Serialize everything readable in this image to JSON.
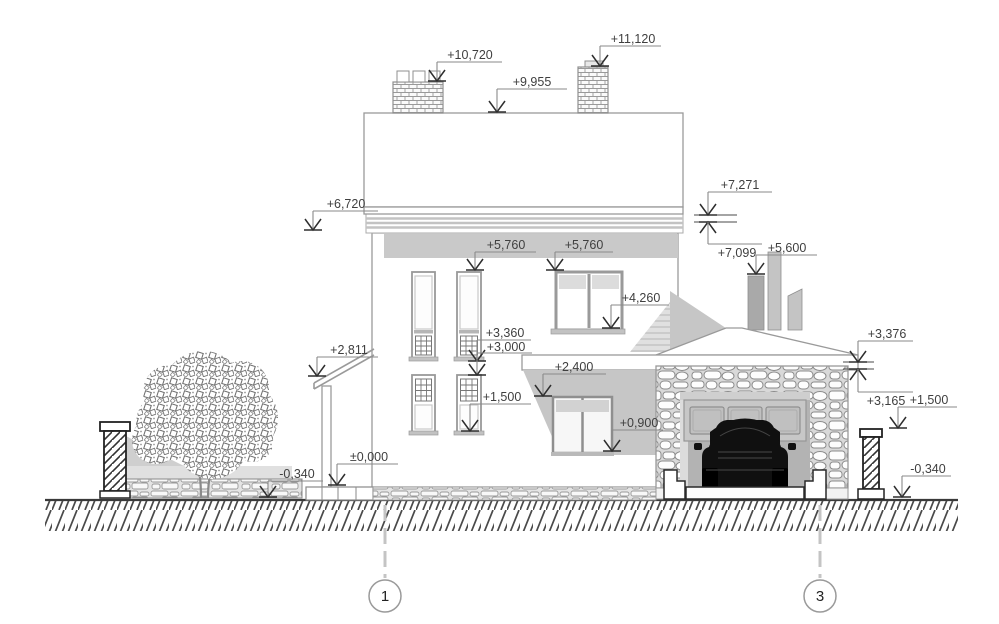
{
  "drawing": {
    "type": "architectural-elevation",
    "subject": "house side elevation between axes 1 and 3",
    "colors": {
      "outline": "#9a9a9a",
      "dark_outline": "#2a2a2a",
      "annotation_text": "#3f3f3f",
      "band_gray": "#c9c9c9",
      "recess_gray": "#c6c6c6",
      "garage_interior": "#b3b3b3",
      "car": "#101010",
      "background": "#ffffff"
    },
    "levels": [
      {
        "id": "chimney-left-top",
        "label": "+10,720"
      },
      {
        "id": "roof-top",
        "label": "+9,955"
      },
      {
        "id": "chimney-right-top",
        "label": "+11,120"
      },
      {
        "id": "roof-edge-top",
        "label": "+7,271"
      },
      {
        "id": "roof-edge-bottom",
        "label": "+7,099"
      },
      {
        "id": "flue-top",
        "label": "+5,600"
      },
      {
        "id": "main-eaves",
        "label": "+6,720"
      },
      {
        "id": "window-head-left",
        "label": "+5,760"
      },
      {
        "id": "window-head-right",
        "label": "+5,760"
      },
      {
        "id": "upper-right-window-sill",
        "label": "+4,260"
      },
      {
        "id": "upper-left-window-sill",
        "label": "+3,360"
      },
      {
        "id": "porch-roof-high",
        "label": "+3,000"
      },
      {
        "id": "porch-roof-low",
        "label": "+2,811"
      },
      {
        "id": "terrace-window-head",
        "label": "+2,400"
      },
      {
        "id": "lower-window-sill",
        "label": "+1,500"
      },
      {
        "id": "terrace-window-sill",
        "label": "+0,900"
      },
      {
        "id": "floor-zero",
        "label": "±0,000"
      },
      {
        "id": "ground-left",
        "label": "-0,340"
      },
      {
        "id": "garage-eaves-top",
        "label": "+3,376"
      },
      {
        "id": "garage-eaves-bottom",
        "label": "+3,165"
      },
      {
        "id": "fence-post-top",
        "label": "+1,500"
      },
      {
        "id": "ground-right",
        "label": "-0,340"
      }
    ],
    "axes": [
      {
        "id": "axis-1",
        "label": "1"
      },
      {
        "id": "axis-3",
        "label": "3"
      }
    ]
  }
}
